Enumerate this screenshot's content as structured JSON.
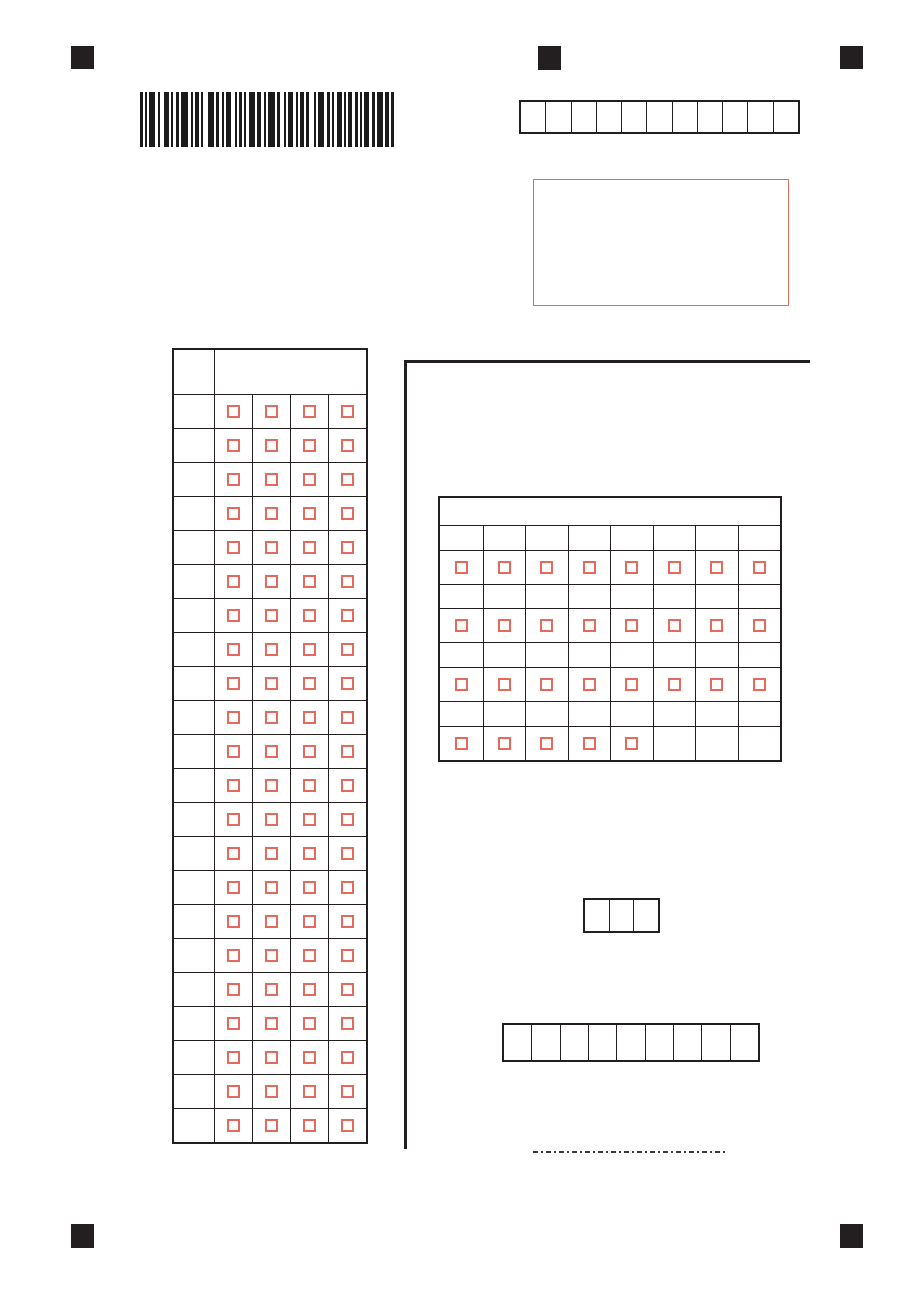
{
  "colors": {
    "ink": "#231f20",
    "checkbox_red": "#e7695a",
    "frame_red": "#e7695a"
  },
  "registration_marks": [
    "top-left",
    "top-center",
    "top-right",
    "bottom-left",
    "bottom-right"
  ],
  "barcode": {
    "pattern": [
      3,
      2,
      2,
      2,
      6,
      3,
      2,
      4,
      5,
      2,
      2,
      3,
      3,
      2,
      7,
      3,
      2,
      2,
      4,
      2,
      2,
      5,
      6,
      2,
      3,
      3,
      2,
      2,
      5,
      4,
      2,
      2,
      3,
      2,
      2,
      3,
      6,
      2,
      4,
      3,
      2,
      2,
      7,
      2,
      3,
      4,
      2,
      2,
      5,
      3,
      2,
      2,
      4,
      2,
      3,
      5,
      2,
      2,
      6,
      3,
      3,
      2,
      2,
      3,
      5,
      2,
      2,
      2,
      4,
      3,
      3,
      2,
      2,
      2,
      5,
      3,
      3,
      2,
      6,
      2,
      4,
      2,
      3
    ]
  },
  "top_code_row": {
    "cell_count": 11,
    "values": [
      "",
      "",
      "",
      "",
      "",
      "",
      "",
      "",
      "",
      "",
      ""
    ]
  },
  "red_frame_box": {
    "content": ""
  },
  "left_answer_grid": {
    "header_text": "",
    "number_column_text": "",
    "row_count": 22,
    "option_count": 4,
    "checked": []
  },
  "right_answer_grid": {
    "header_text": "",
    "column_count": 8,
    "label_row_text": "",
    "checkbox_rows": [
      [
        1,
        1,
        1,
        1,
        1,
        1,
        1,
        1
      ],
      [
        1,
        1,
        1,
        1,
        1,
        1,
        1,
        1
      ],
      [
        1,
        1,
        1,
        1,
        1,
        1,
        1,
        1
      ],
      [
        1,
        1,
        1,
        1,
        1,
        0,
        0,
        0
      ]
    ]
  },
  "small_code_row": {
    "cell_count": 3,
    "values": [
      "",
      "",
      ""
    ]
  },
  "wide_code_row": {
    "cell_count": 9,
    "values": [
      "",
      "",
      "",
      "",
      "",
      "",
      "",
      "",
      ""
    ]
  },
  "dotted_line": {
    "present": true
  }
}
